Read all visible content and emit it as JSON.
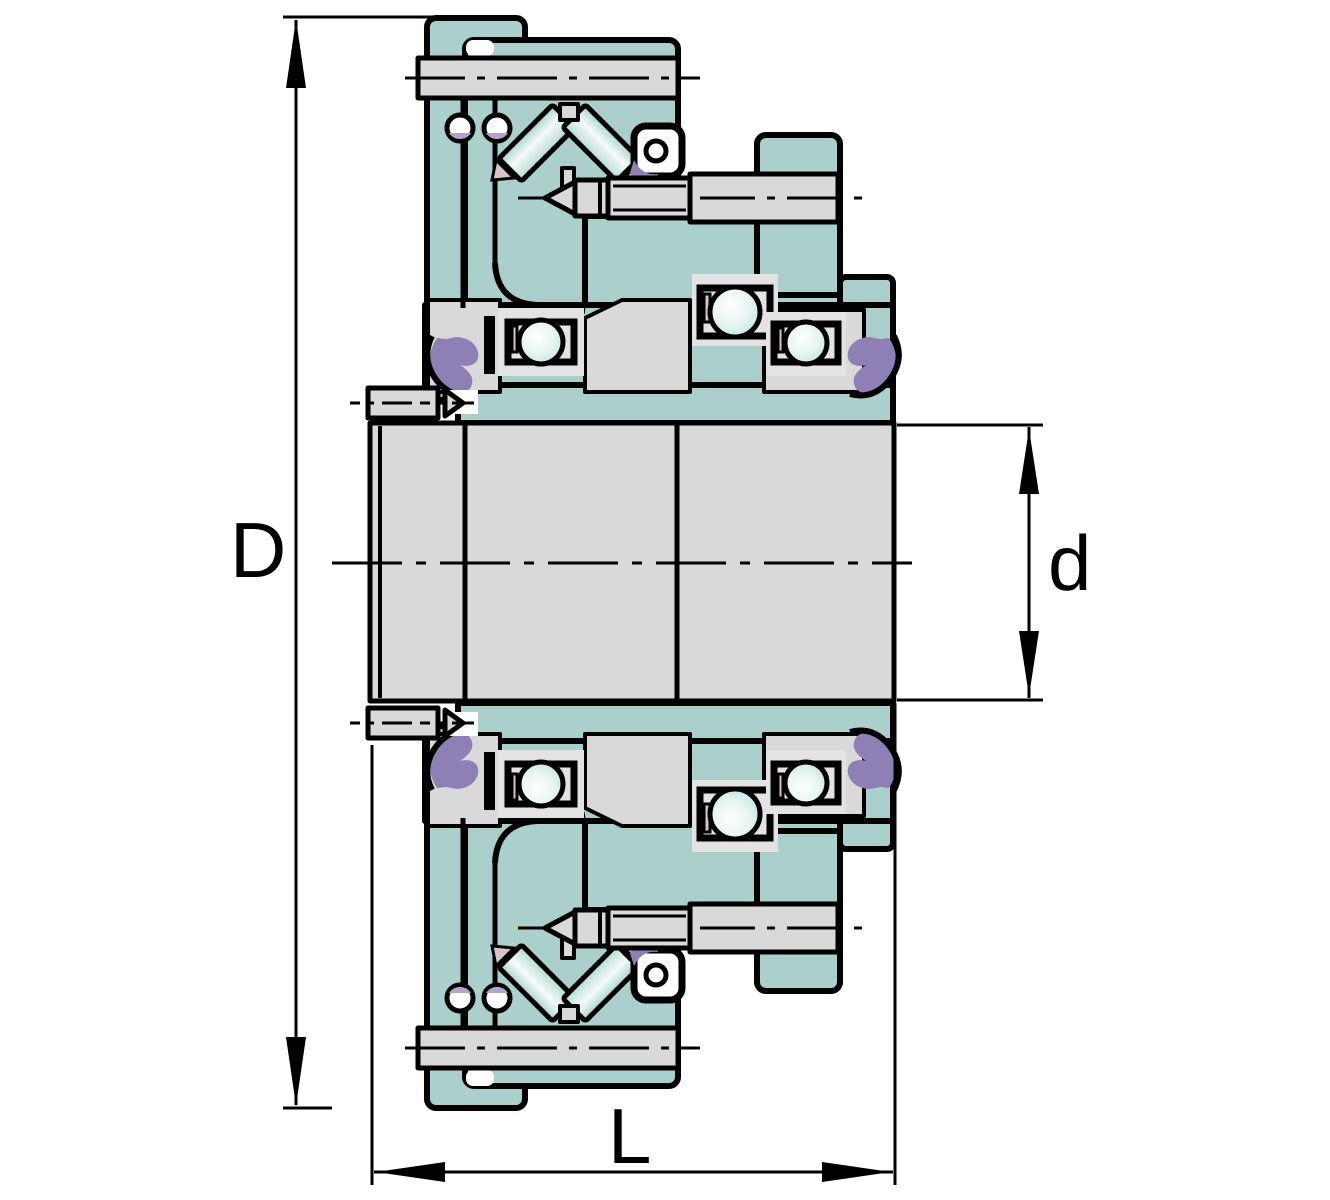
{
  "figure": {
    "type": "engineering-cross-section",
    "description": "Sectioned bearing unit drawing with outer diameter, bore diameter and length callouts",
    "dimensions": {
      "outer_diameter_label": "D",
      "bore_diameter_label": "d",
      "length_label": "L"
    },
    "colors": {
      "housing_teal": "#abcfca",
      "steel_gray": "#d9d9d9",
      "steel_gray_light": "#e3e3e3",
      "seal_purple": "#8e7fb5",
      "seal_purple_light": "#b0a5cd",
      "cage_pink": "#d9c3c8",
      "ball_mint": "#c5e6e0",
      "outline_black": "#000000",
      "background": "#ffffff"
    }
  }
}
